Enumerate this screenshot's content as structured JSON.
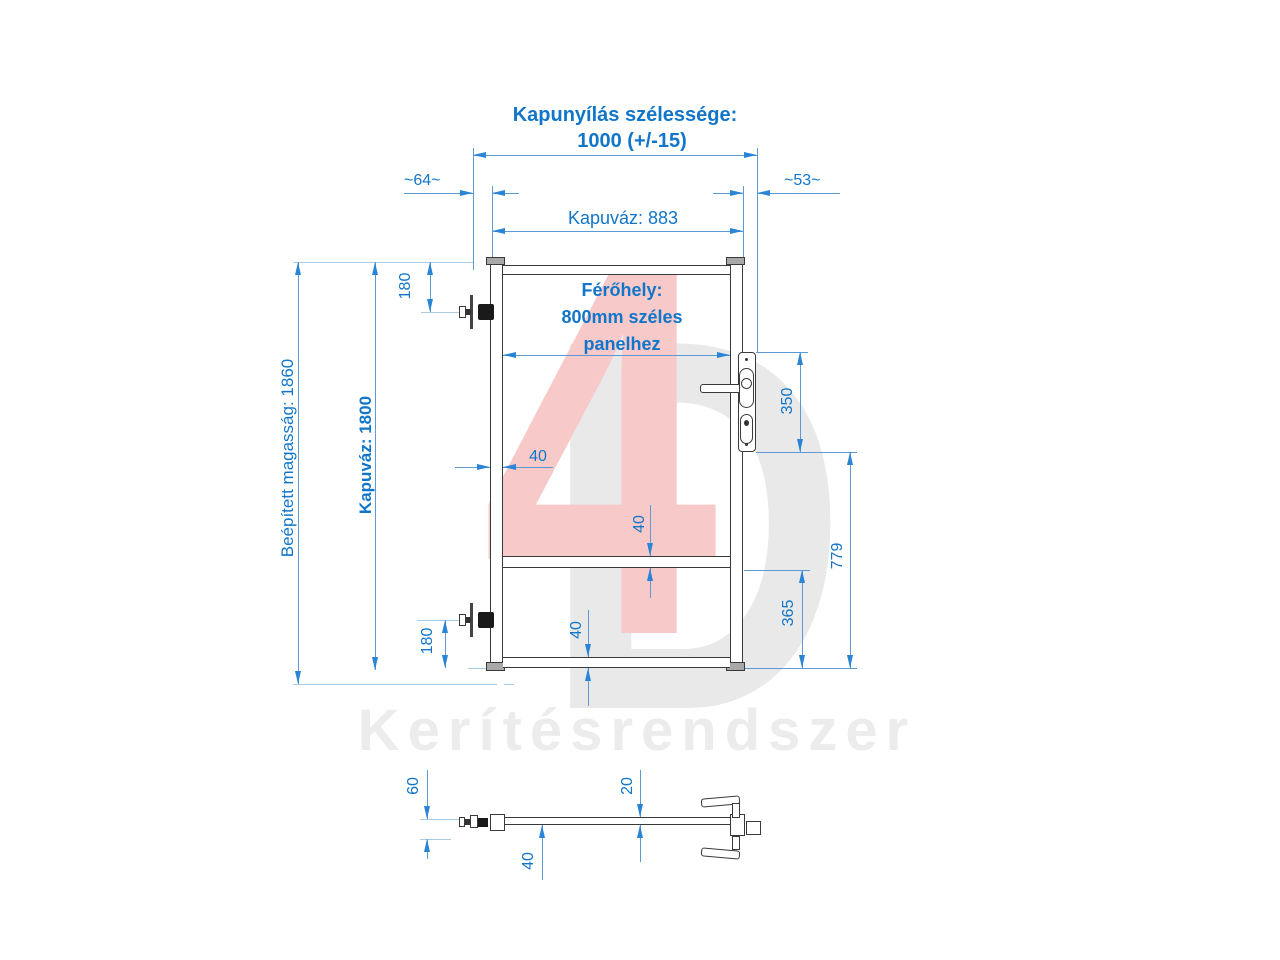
{
  "drawing": {
    "header": {
      "opening_width_label": "Kapunyílás szélessége:",
      "opening_width_value": "1000 (+/-15)",
      "left_gap": "~64~",
      "right_gap": "~53~",
      "frame_width": "Kapuváz: 883"
    },
    "gate": {
      "fit_label_line1": "Férőhely:",
      "fit_label_line2": "800mm széles",
      "fit_label_line3": "panelhez",
      "built_in_height": "Beépített magasság: 1860",
      "frame_height": "Kapuváz: 1800",
      "hinge_top_offset": "180",
      "hinge_bottom_offset": "180",
      "post_width": "40",
      "mid_rail_thickness": "40",
      "bottom_rail_thickness": "40",
      "lock_height": "350",
      "lock_to_bottom": "779",
      "mid_rail_to_bottom": "365"
    },
    "section": {
      "hinge_offset": "60",
      "bar_thickness": "20",
      "frame_depth": "40"
    },
    "watermark": {
      "logo_4": "4",
      "logo_d": "D",
      "brand": "Kerítésrendszer"
    },
    "colors": {
      "dimension_text_blue": "#1176c9",
      "dimension_line_blue": "#5b9bd5",
      "geometry_dark": "#3a3a3a",
      "watermark_pink": "#f7c9c9",
      "watermark_gray": "#e9e9e9"
    }
  }
}
